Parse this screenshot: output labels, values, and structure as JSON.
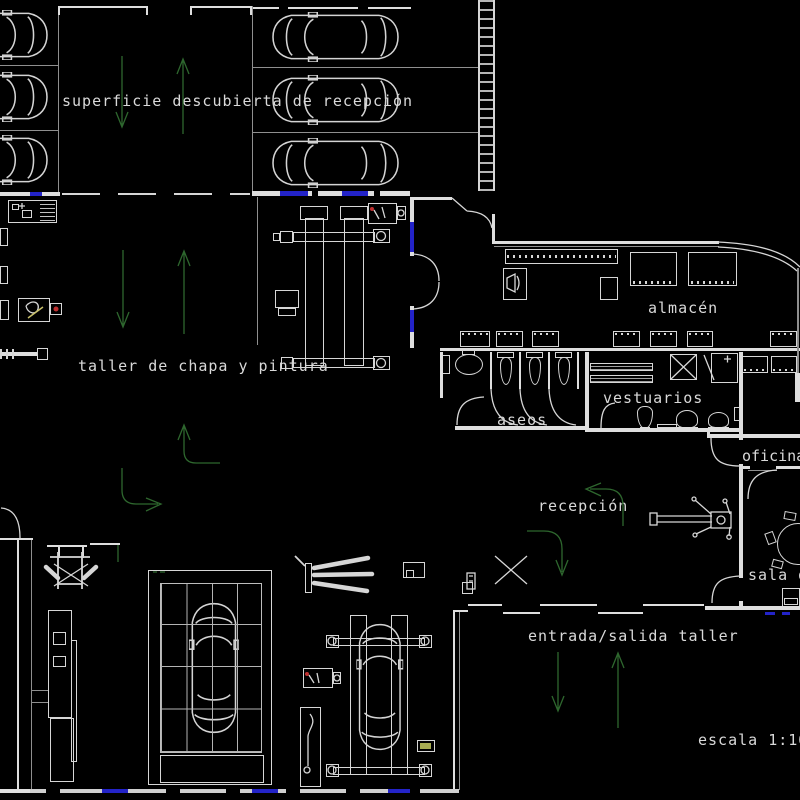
{
  "meta": {
    "type": "CAD floor plan",
    "drawing_title": "workshop (taller) floor plan",
    "background_color": "#000000",
    "line_color": "#dedede",
    "arrow_color": "#2e672e",
    "door_marker_color": "#2323c8",
    "scale": "1:100"
  },
  "labels": {
    "superficie": "superficie descubierta de recepción",
    "taller": "taller de chapa y pintura",
    "almacen": "almacén",
    "aseos": "aseos",
    "vestuarios": "vestuarios",
    "oficina": "oficina",
    "recepcion": "recepción",
    "sala": "sala d",
    "entrada": "entrada/salida taller",
    "escala": "escala 1:100"
  }
}
